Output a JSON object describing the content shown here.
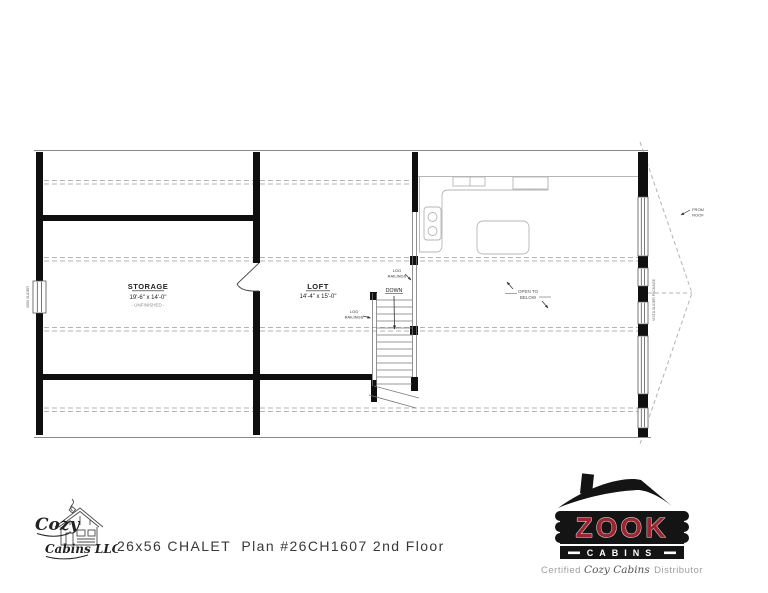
{
  "plan": {
    "storage": {
      "name": "STORAGE",
      "dims": "19'-6\" x 14'-0\"",
      "note": "- UNFINISHED -"
    },
    "loft": {
      "name": "LOFT",
      "dims": "14'-4\" x 15'-0\""
    },
    "stairs": {
      "down": "DOWN"
    },
    "railing_label": {
      "l1": "LOG",
      "l2": "RAILINGS"
    },
    "open_below": {
      "l1": "OPEN TO",
      "l2": "BELOW"
    },
    "from_roof": {
      "l1": "FROM",
      "l2": "ROOF"
    },
    "left_window_label": "3050 SLIDER",
    "right_window_label": "VISTA SLIDER PACKAGE"
  },
  "footer": {
    "title": "26x56 CHALET  Plan #26CH1607 2nd Floor",
    "cozy": {
      "word1": "Cozy",
      "word2": "Cabins LLC"
    },
    "zook": {
      "name": "ZOOK",
      "sub": "CABINS",
      "tag1": "Certified ",
      "tag2": "Cozy Cabins",
      "tag3": " Distributor"
    }
  },
  "colors": {
    "zook_red": "#9b2631",
    "ink": "#111111",
    "dash": "#a8a8a8"
  }
}
